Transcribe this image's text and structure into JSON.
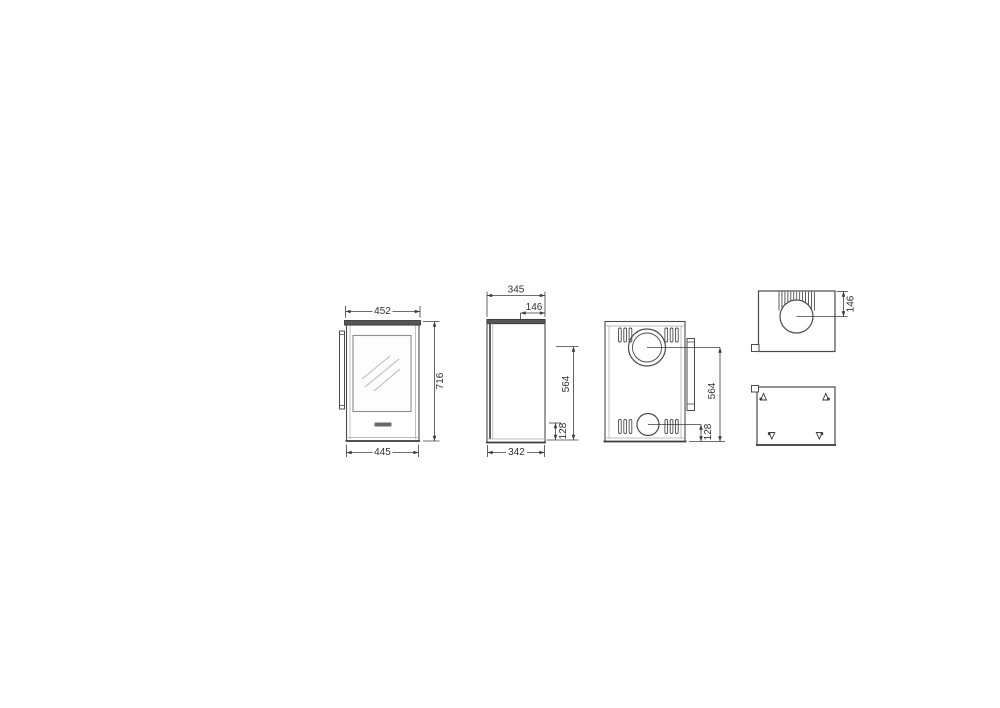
{
  "dims": {
    "front": {
      "top_width": "452",
      "overall_height": "716",
      "bottom_width": "445"
    },
    "side": {
      "top_depth": "345",
      "flue_center_from_back": "146",
      "flue_center_height": "564",
      "intake_center_height": "128",
      "bottom_depth": "342"
    },
    "back": {
      "flue_center_height": "564",
      "intake_center_height": "128"
    },
    "top": {
      "flue_center_from_back": "146"
    }
  },
  "colors": {
    "line_dark": "#3c3c3e",
    "line_mid": "#4b4b4e",
    "line_light": "#a6a6a8",
    "plate_fill": "#55555a",
    "logo_fill": "#69696c",
    "background": "#ffffff"
  }
}
